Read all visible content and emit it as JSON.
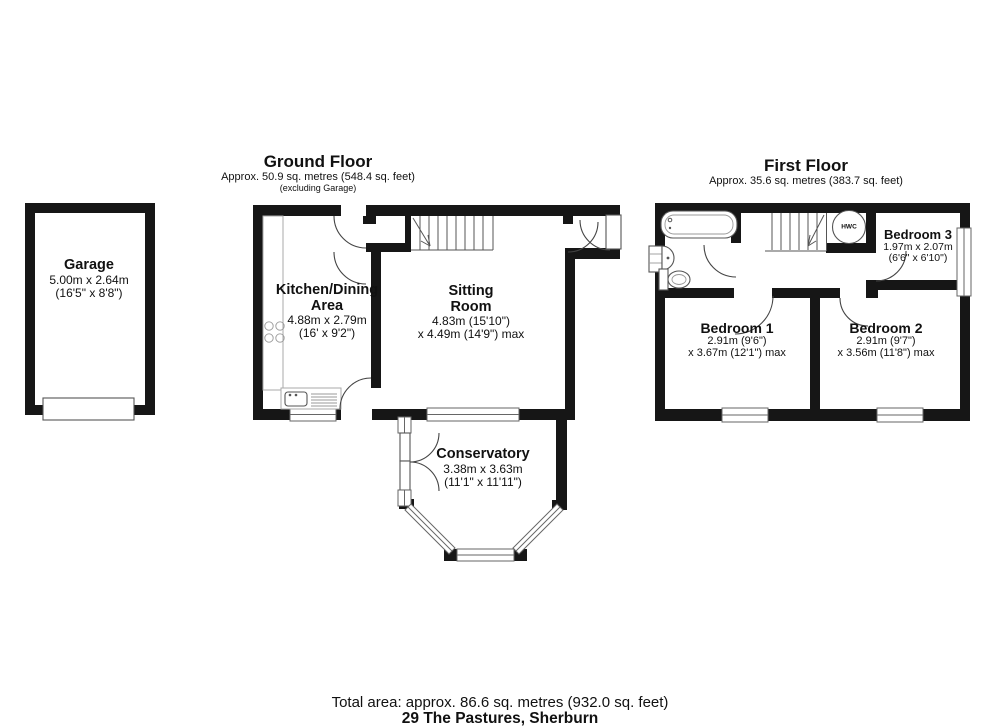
{
  "floors": {
    "ground": {
      "title": "Ground Floor",
      "area": "Approx. 50.9 sq. metres (548.4 sq. feet)",
      "note": "(excluding Garage)"
    },
    "first": {
      "title": "First Floor",
      "area": "Approx. 35.6 sq. metres (383.7 sq. feet)"
    }
  },
  "rooms": {
    "garage": {
      "name": "Garage",
      "dims1": "5.00m x 2.64m",
      "dims2": "(16'5\" x 8'8\")"
    },
    "kitchen": {
      "name1": "Kitchen/Dining",
      "name2": "Area",
      "dims1": "4.88m x 2.79m",
      "dims2": "(16' x 9'2\")"
    },
    "sitting": {
      "name1": "Sitting",
      "name2": "Room",
      "dims1": "4.83m (15'10\")",
      "dims2": "x 4.49m (14'9\") max"
    },
    "conservatory": {
      "name": "Conservatory",
      "dims1": "3.38m x 3.63m",
      "dims2": "(11'1\" x 11'11\")"
    },
    "bedroom1": {
      "name": "Bedroom 1",
      "dims1": "2.91m (9'6\")",
      "dims2": "x 3.67m (12'1\") max"
    },
    "bedroom2": {
      "name": "Bedroom 2",
      "dims1": "2.91m (9'7\")",
      "dims2": "x 3.56m (11'8\") max"
    },
    "bedroom3": {
      "name": "Bedroom 3",
      "dims1": "1.97m x 2.07m",
      "dims2": "(6'6\" x 6'10\")"
    },
    "hwc": {
      "label": "HWC"
    }
  },
  "footer": {
    "total_area": "Total area: approx. 86.6 sq. metres (932.0 sq. feet)",
    "address": "29 The Pastures, Sherburn"
  }
}
